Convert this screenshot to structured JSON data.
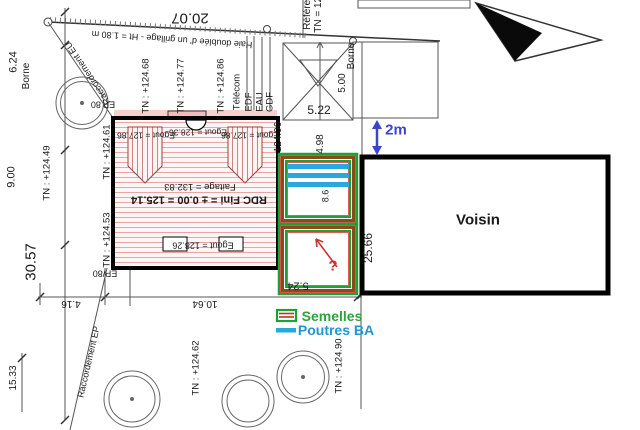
{
  "boundary": {
    "north_length": "20.07",
    "hedge_note": "Haie doublée d' un grillage - Ht = 1.80 m",
    "reference_label": "Référen",
    "reference_tn": "TN = 125",
    "borne_west": "Borne",
    "borne_east": "Borne"
  },
  "dimensions": {
    "west_1": "6.24",
    "west_2": "9.00",
    "west_total": "30.57",
    "west_3": "15.33",
    "south_1": "4.16",
    "south_2": "10.64",
    "east_1": "5.22",
    "east_2": "5.00",
    "voisin_side": "25.66",
    "foundation_width": "5.24",
    "foundation_side": "8.6"
  },
  "elevations": {
    "tn_1": "TN : +124.68",
    "tn_2": "TN : +124.77",
    "tn_3": "TN : +124.86",
    "tn_4": "TN : +124.49",
    "tn_5": "TN : +124.61",
    "tn_6": "TN : +124.53",
    "tn_7": "TN : +124.62",
    "tn_8": "TN : +124.90",
    "tn_9": "124.96",
    "tn_10": "4.98"
  },
  "house": {
    "egout_left": "Egout = 127.86",
    "egout_mid": "Egout = 128.36",
    "egout_right": "Egout = 127.86",
    "egout_bottom": "Egout = 128.26",
    "faitage": "Faitage = 132.83",
    "rdc_fini": "RDC Fini = ± 0.00 = 125.14",
    "ep_top": "EP 80",
    "ep_bottom": "EP/80"
  },
  "networks": {
    "telecom": "Télécom",
    "edf": "EDF",
    "eau": "EAU",
    "gdf": "GDF",
    "racc_eu": "Raccordement EU",
    "racc_ep": "Raccordement EP"
  },
  "annotations": {
    "gap": "2m",
    "question": "?",
    "voisin": "Voisin"
  },
  "legend": {
    "semelles": "Semelles",
    "poutres": "Poutres BA"
  },
  "colors": {
    "semelle_green": "#1fa037",
    "semelle_band": "#8a4a1a",
    "poutre_blue": "#29a8e0",
    "annotation_blue": "#3a45cc",
    "annotation_red": "#cc3333"
  }
}
